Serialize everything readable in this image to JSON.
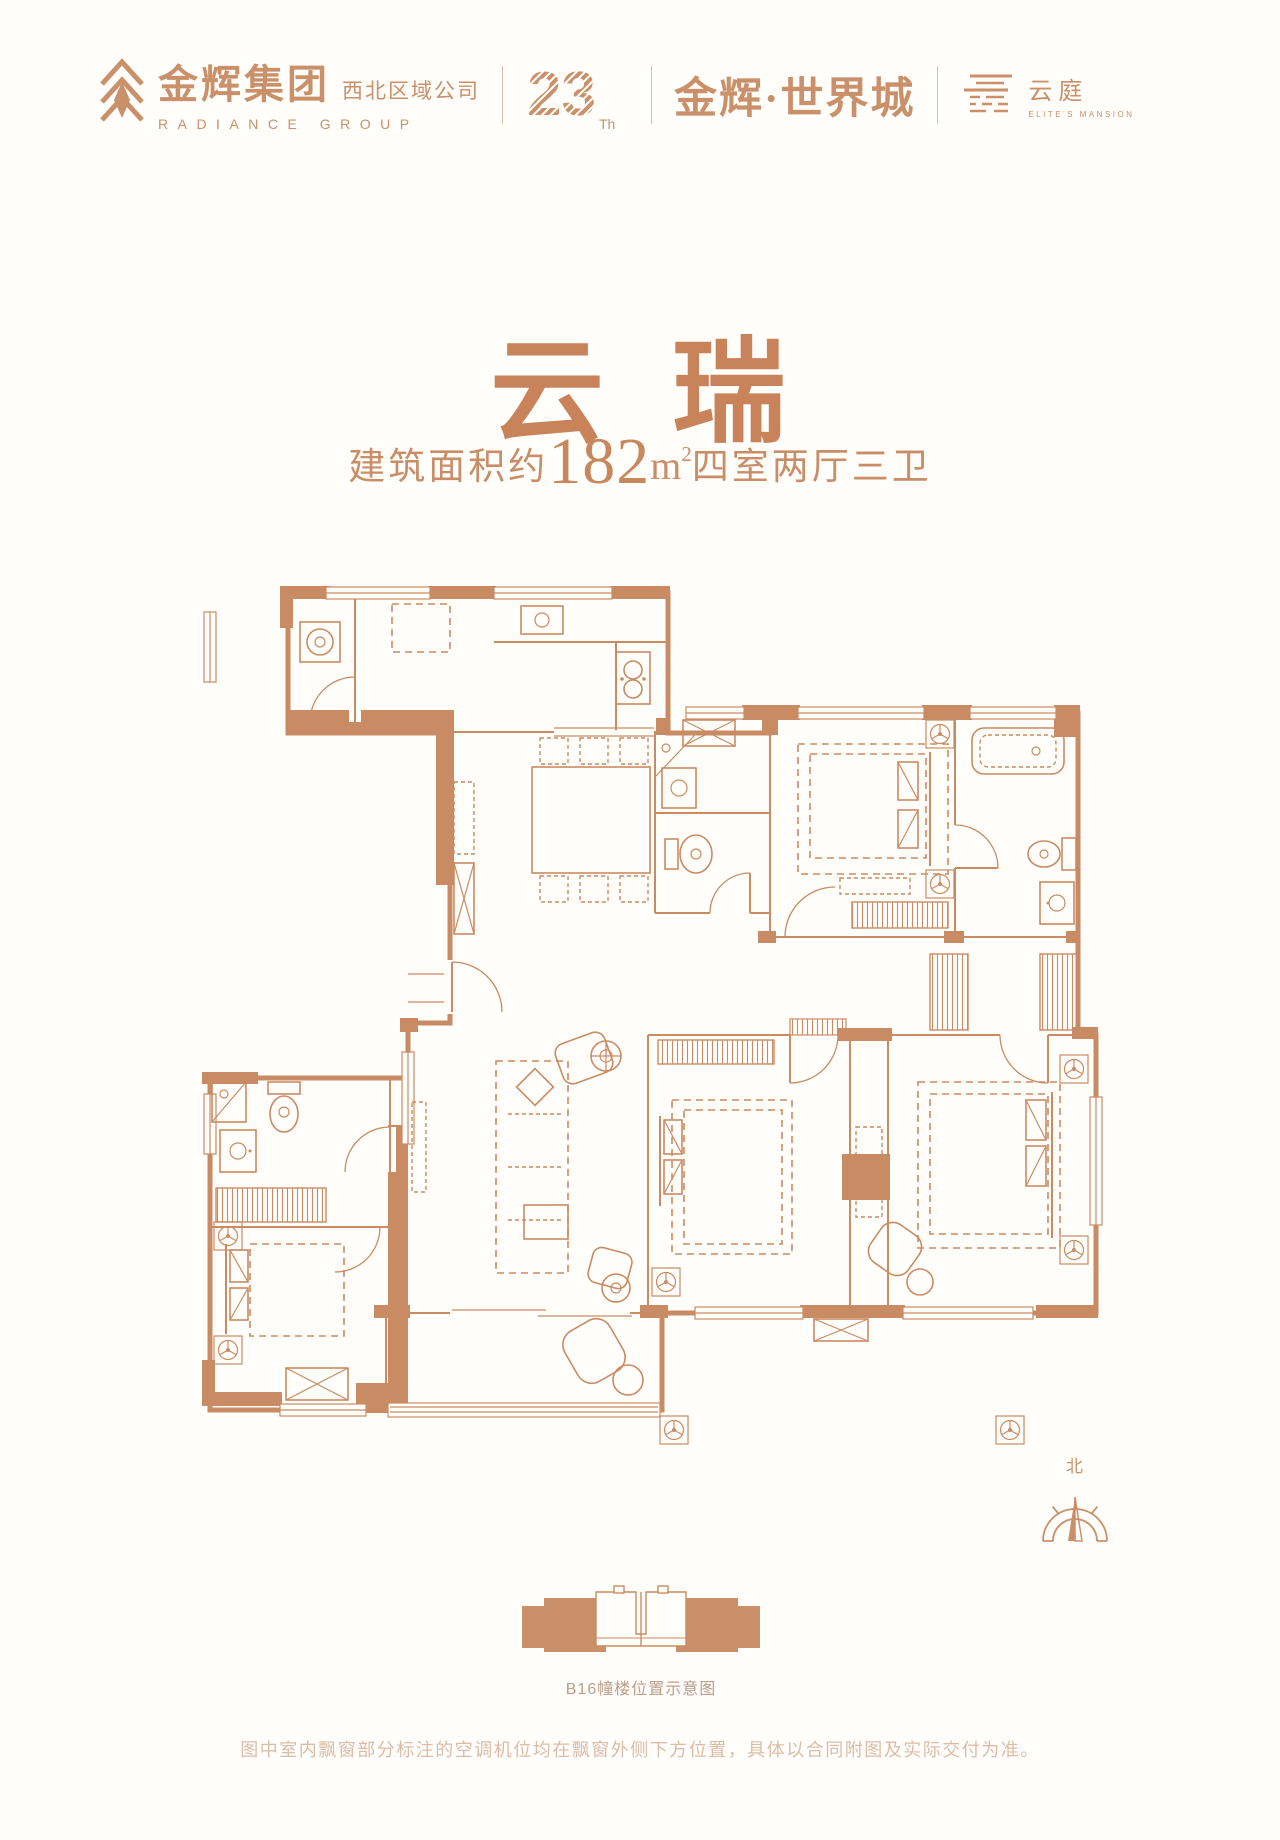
{
  "colors": {
    "accent": "#C9906A",
    "plan_line": "#C98B63",
    "title": "#C9835B",
    "subtitle": "#C98E68",
    "caption": "#BD9D88",
    "disclaimer": "#DCBCA6",
    "background": "#FFFEFB"
  },
  "header": {
    "group": {
      "cn": "金辉集团",
      "region": "西北区域公司",
      "en": "RADIANCE GROUP"
    },
    "anniversary": {
      "number": "23",
      "suffix": "Th"
    },
    "project": {
      "name": "金辉·世界城"
    },
    "mansion": {
      "cn": "云庭",
      "en": "ELITE'S MANSION"
    }
  },
  "hero": {
    "title": "云 瑞",
    "area_prefix": "建筑面积约",
    "area_value": "182",
    "area_unit": "m",
    "area_sup": "2",
    "layout": "四室两厅三卫"
  },
  "plan": {
    "compass_label": "北"
  },
  "locator": {
    "caption": "B16幢楼位置示意图"
  },
  "footer": {
    "disclaimer": "图中室内飘窗部分标注的空调机位均在飘窗外侧下方位置，具体以合同附图及实际交付为准。"
  }
}
